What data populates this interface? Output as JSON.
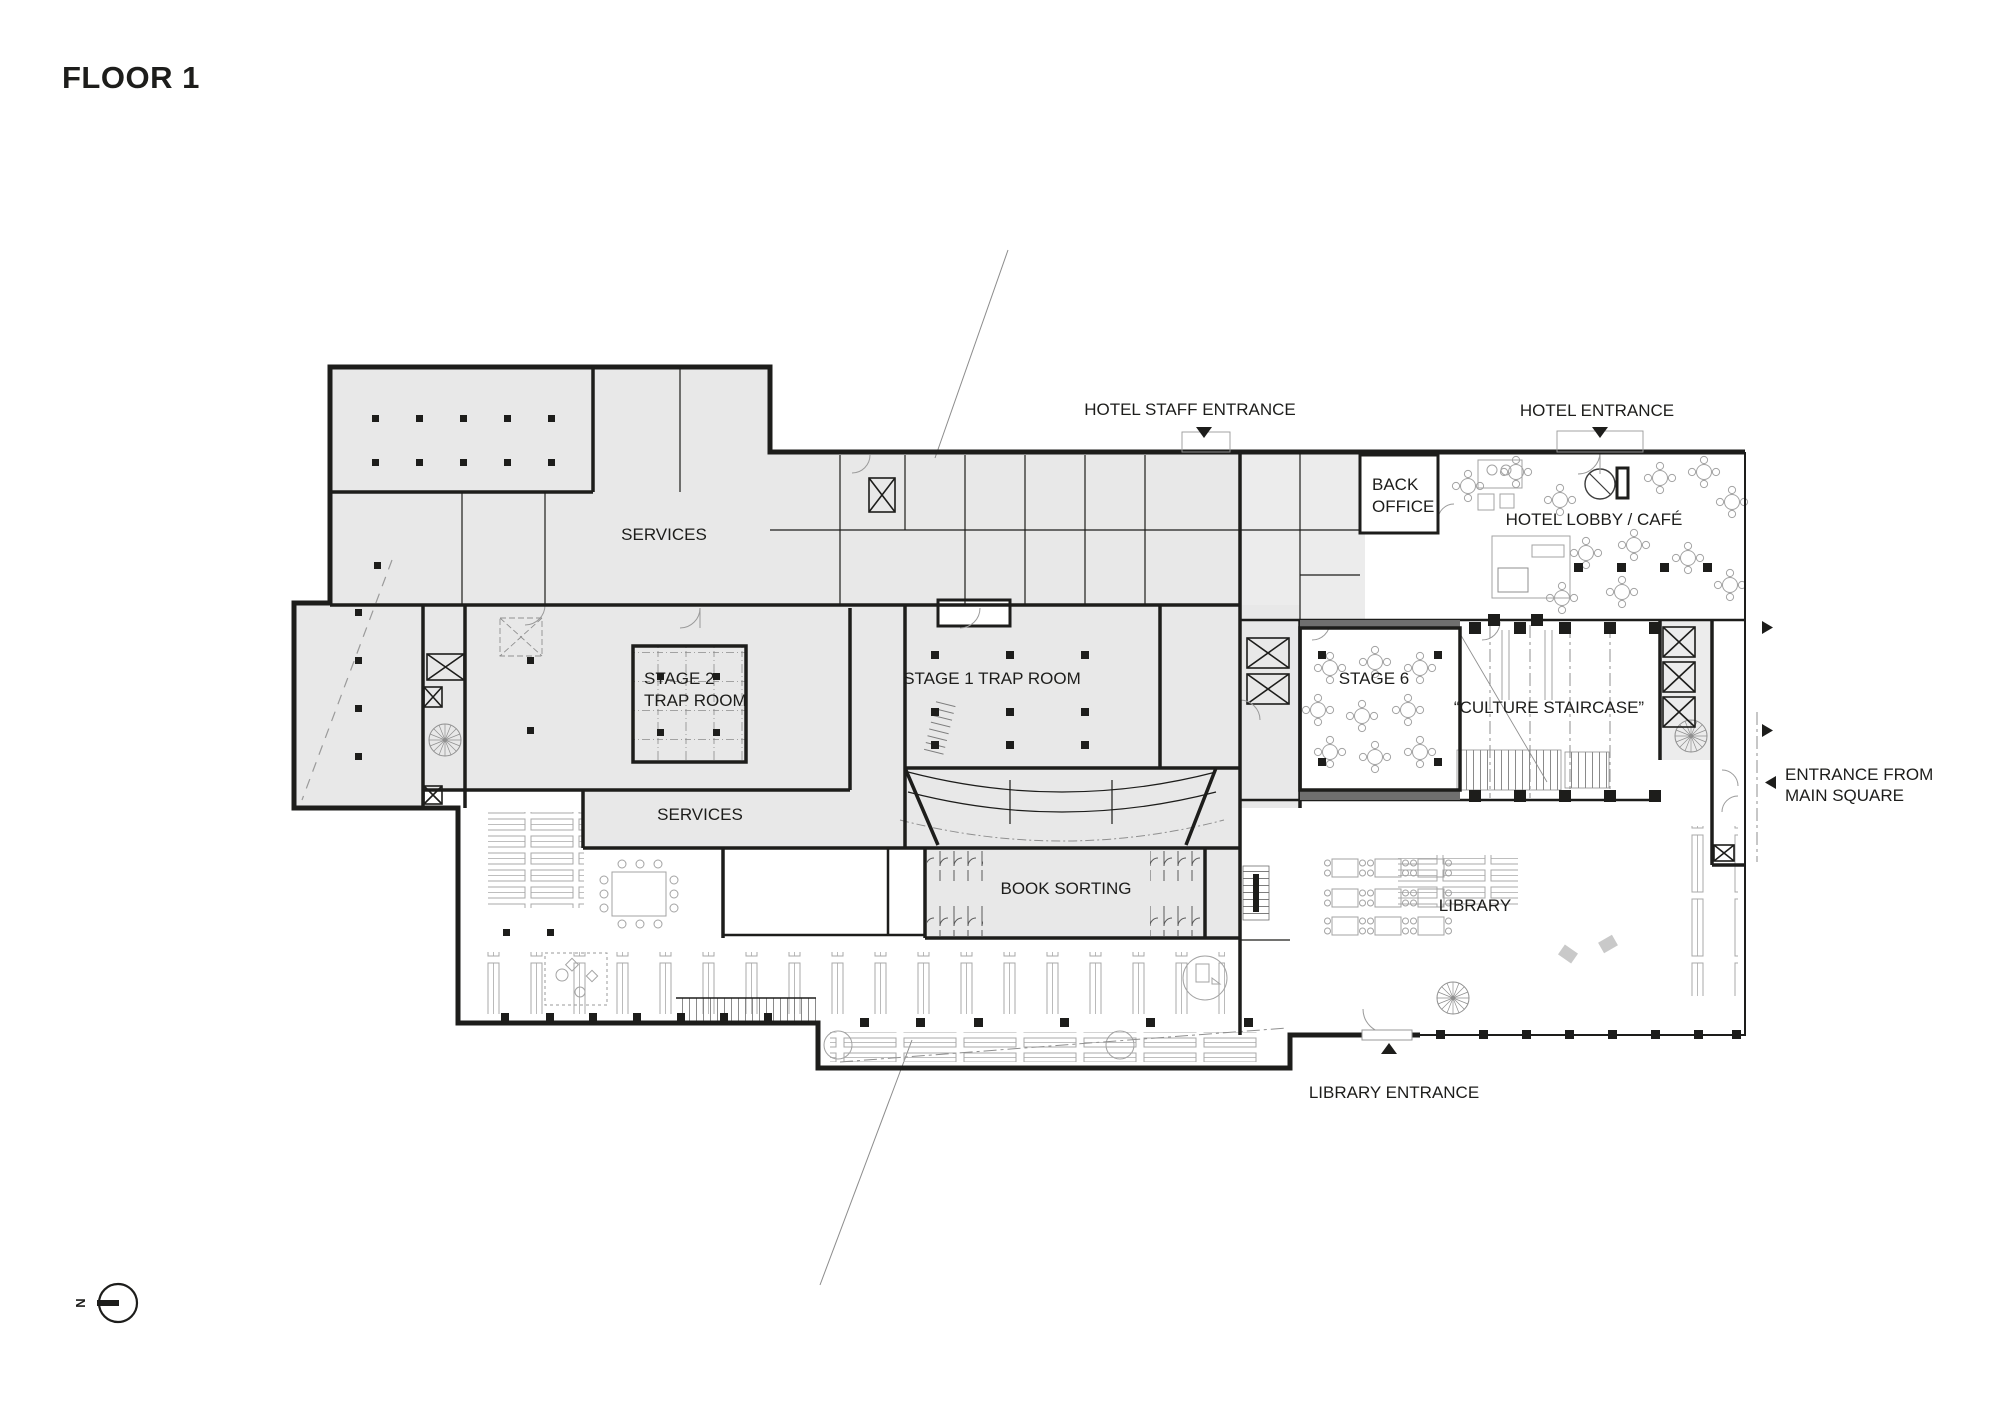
{
  "title": "FLOOR 1",
  "colors": {
    "wall": "#1d1d1b",
    "room_fill": "#e8e8e8",
    "furniture_line": "#a3a3a3",
    "background": "#ffffff",
    "text": "#1d1d1b"
  },
  "rooms": {
    "services_upper": "SERVICES",
    "stage2_line1": "STAGE 2",
    "stage2_line2": "TRAP ROOM",
    "stage1": "STAGE 1 TRAP ROOM",
    "services_lower": "SERVICES",
    "book_sorting": "BOOK SORTING",
    "stage6": "STAGE 6",
    "culture_staircase": "“CULTURE STAIRCASE”",
    "back_office_line1": "BACK",
    "back_office_line2": "OFFICE",
    "hotel_lobby": "HOTEL LOBBY / CAFÉ",
    "library": "LIBRARY"
  },
  "entrances": {
    "hotel_staff": "HOTEL STAFF ENTRANCE",
    "hotel": "HOTEL ENTRANCE",
    "main_square_line1": "ENTRANCE FROM",
    "main_square_line2": "MAIN SQUARE",
    "library": "LIBRARY ENTRANCE"
  },
  "compass": {
    "north": "N"
  }
}
